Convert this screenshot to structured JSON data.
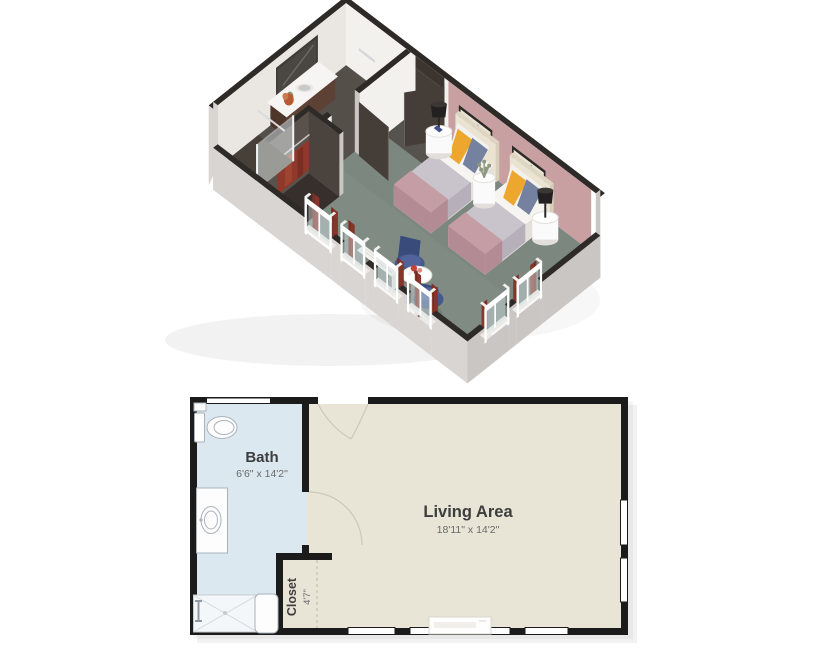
{
  "page": {
    "background": "#ffffff",
    "description": "Assisted living companion suite floor plan, 3D view above 2D view"
  },
  "plan3d": {
    "label": "3d-isometric-unit-view",
    "colors": {
      "wallTop": "#2e2a27",
      "wallWhite": "#f3f1ee",
      "wallShade": "#eae7e3",
      "outerGray": "#d8d5d3",
      "outerGray2": "#c9c6c3",
      "pink": "#c9a0a2",
      "carpet": "#7b877f",
      "tile": "#554f4a",
      "tileDark": "#453f3b",
      "entryTile": "#56524e",
      "door": "#453d38",
      "closet": "#362f2b",
      "clothesRed": "#8e392b",
      "curtainRed": "#87352a",
      "glass": "#d2e0e5",
      "frame": "#ffffff",
      "headboard": "#eae3d2",
      "mattress": "#f6f4f1",
      "mattressSide": "#e4e0da",
      "blanket": "#c9c3cb",
      "blanketSide": "#b7b0ba",
      "throw": "#c59da5",
      "throwSide": "#b28b94",
      "pillowYellow": "#eda72f",
      "pillowBlue": "#7482a0",
      "stand": "#fbfafa",
      "lamp": "#222020",
      "chairBlue": "#46598b",
      "chairBlueDark": "#394b7b",
      "wood": "#8a6a4e",
      "plant": "#8d987f",
      "flower": "#c2453c"
    }
  },
  "plan2d": {
    "wall_color": "#1b1b1b",
    "rooms": [
      {
        "id": "bath",
        "label": "Bath",
        "dimensions": "6'6\" x 14'2\"",
        "floor_color": "#dce8f0"
      },
      {
        "id": "living",
        "label": "Living Area",
        "dimensions": "18'11\" x 14'2\"",
        "floor_color": "#e8e5d7"
      },
      {
        "id": "closet",
        "label": "Closet",
        "dimensions": "4'7\"",
        "floor_color": "#e8e5d7"
      }
    ],
    "label_color": "#3d3d3d",
    "dim_color": "#6a6a6a"
  }
}
